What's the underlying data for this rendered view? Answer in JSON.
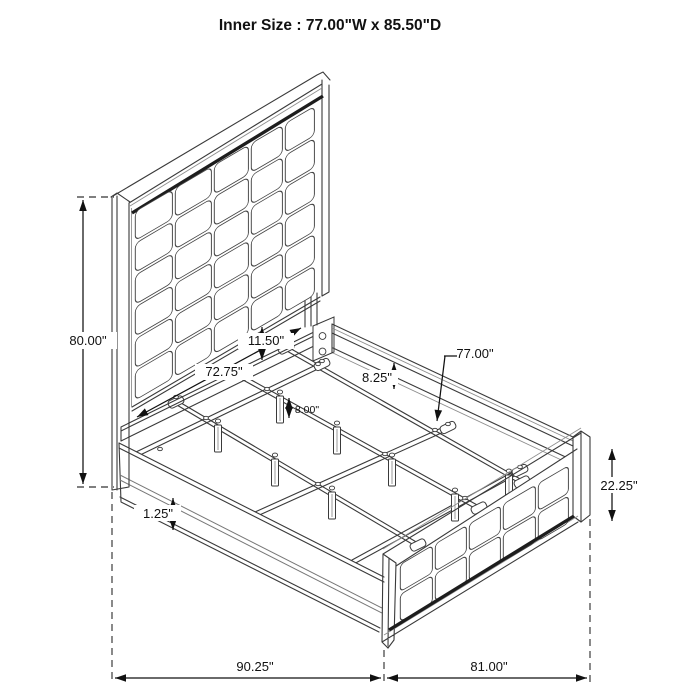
{
  "title": "Inner Size : 77.00\"W x 85.50\"D",
  "dimensions": {
    "headboard_height": "80.00\"",
    "head_rail_width": "72.75\"",
    "panel_clearance": "11.50\"",
    "side_rail_height": "8.25\"",
    "leg_height": "8.00\"",
    "slat_length": "77.00\"",
    "rail_trim": "1.25\"",
    "footboard_height": "22.25\"",
    "overall_depth": "90.25\"",
    "overall_width": "81.00\""
  },
  "colors": {
    "line": "#3a3a3a",
    "dark_accent": "#1d1d1d",
    "text": "#111111",
    "background": "#ffffff"
  }
}
